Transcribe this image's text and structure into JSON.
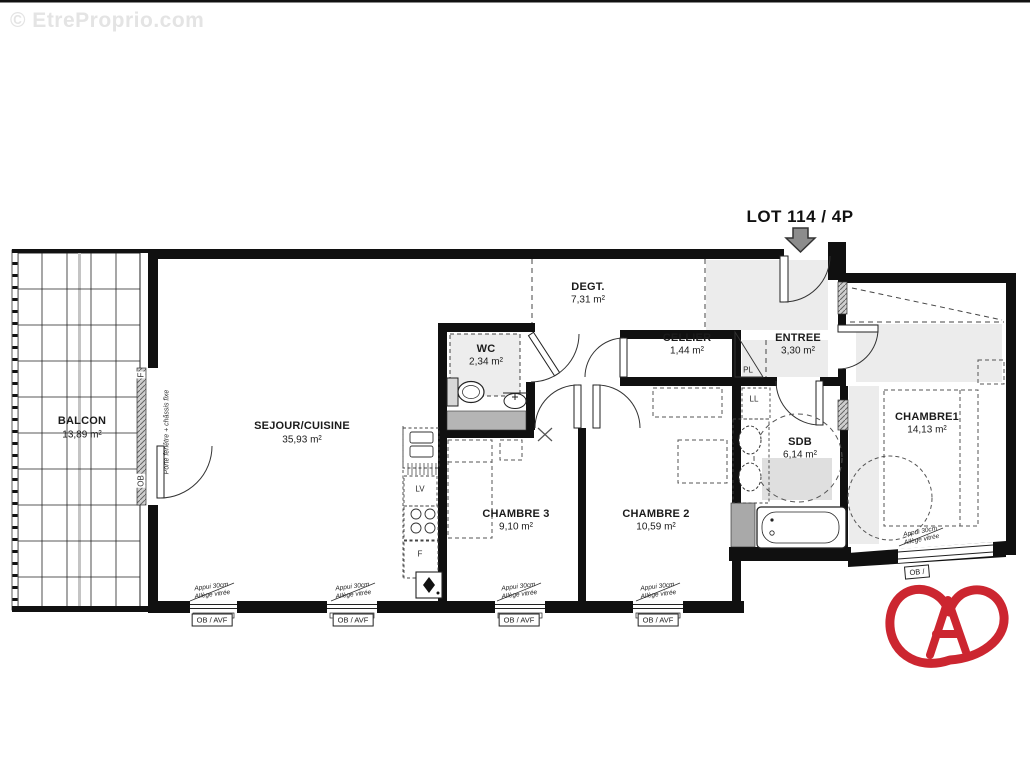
{
  "watermark": "© EtreProprio.com",
  "lot_label": "LOT 114 / 4P",
  "rooms": [
    {
      "name": "BALCON",
      "area": "13,89 m²"
    },
    {
      "name": "SEJOUR/CUISINE",
      "area": "35,93 m²"
    },
    {
      "name": "DEGT.",
      "area": "7,31 m²"
    },
    {
      "name": "WC",
      "area": "2,34 m²"
    },
    {
      "name": "CELLIER",
      "area": "1,44 m²"
    },
    {
      "name": "ENTREE",
      "area": "3,30 m²"
    },
    {
      "name": "SDB",
      "area": "6,14 m²"
    },
    {
      "name": "CHAMBRE1",
      "area": "14,13 m²"
    },
    {
      "name": "CHAMBRE 3",
      "area": "9,10 m²"
    },
    {
      "name": "CHAMBRE 2",
      "area": "10,59 m²"
    }
  ],
  "fixtures": {
    "pl": "PL",
    "ll": "LL",
    "lv": "LV",
    "fridge": "F"
  },
  "openings": {
    "balcony_door_note": "Porte fenêtre + châssis fixe",
    "window_type_f": "F",
    "window_type_ob": "OB",
    "sill_note_line1": "Appui 30cm",
    "sill_note_line2": "Allège vitrée",
    "window_tag": "OB / AVF",
    "window_tag_partial": "OB /"
  },
  "icons": {
    "entrance_arrow": "down-arrow",
    "brand_logo": "heart-letter-A-logo"
  },
  "colors": {
    "wall": "#101010",
    "light_gray_zone": "#ececec",
    "counter_gray": "#b5b5b5",
    "column_gray": "#a9a9a9",
    "watermark_gray": "#e4e4e4",
    "arrow_gray": "#8c8c8c",
    "logo_red": "#cc2630"
  }
}
